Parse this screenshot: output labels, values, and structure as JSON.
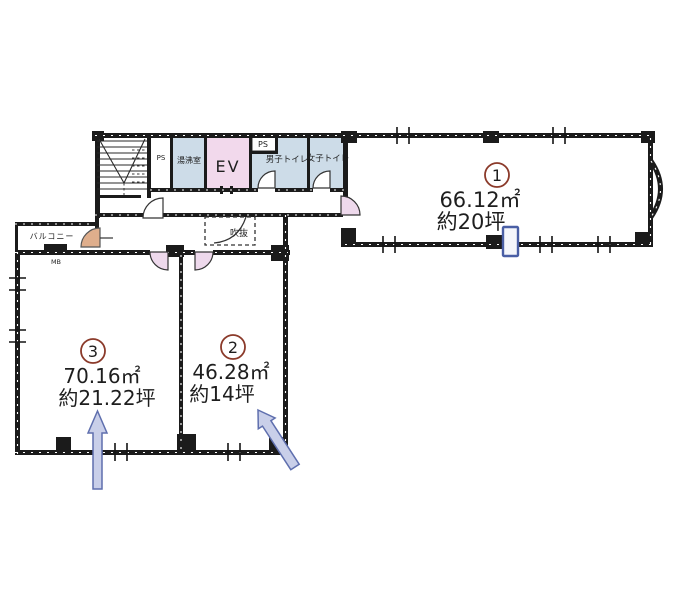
{
  "rooms": [
    {
      "number": "1",
      "area_sqm": "66.12㎡",
      "area_tsubo": "約20坪"
    },
    {
      "number": "2",
      "area_sqm": "46.28㎡",
      "area_tsubo": "約14坪"
    },
    {
      "number": "3",
      "area_sqm": "70.16㎡",
      "area_tsubo": "約21.22坪"
    }
  ],
  "labels": {
    "elevator": "EV",
    "pipe_space_top": "PS",
    "pipe_space_side": "PS",
    "mens_toilet": "男子トイレ",
    "womens_toilet": "女子トイレ",
    "kitchenette": "湯沸室",
    "balcony": "バルコニー",
    "atrium_void": "吹抜",
    "meter_box": "MB"
  },
  "colors": {
    "wall": "#1b1b1b",
    "room_tint": "#cddce8",
    "elevator_tint": "#f2d9ec",
    "door_tint": "#eed9ec",
    "balcony_door_tint": "#dfae8c",
    "arrow_fill": "#c9cfe9",
    "arrow_stroke": "#5f6fae",
    "room_number_circle": "#8b3a2a",
    "entry_marker_stroke": "#4a5fa5"
  }
}
